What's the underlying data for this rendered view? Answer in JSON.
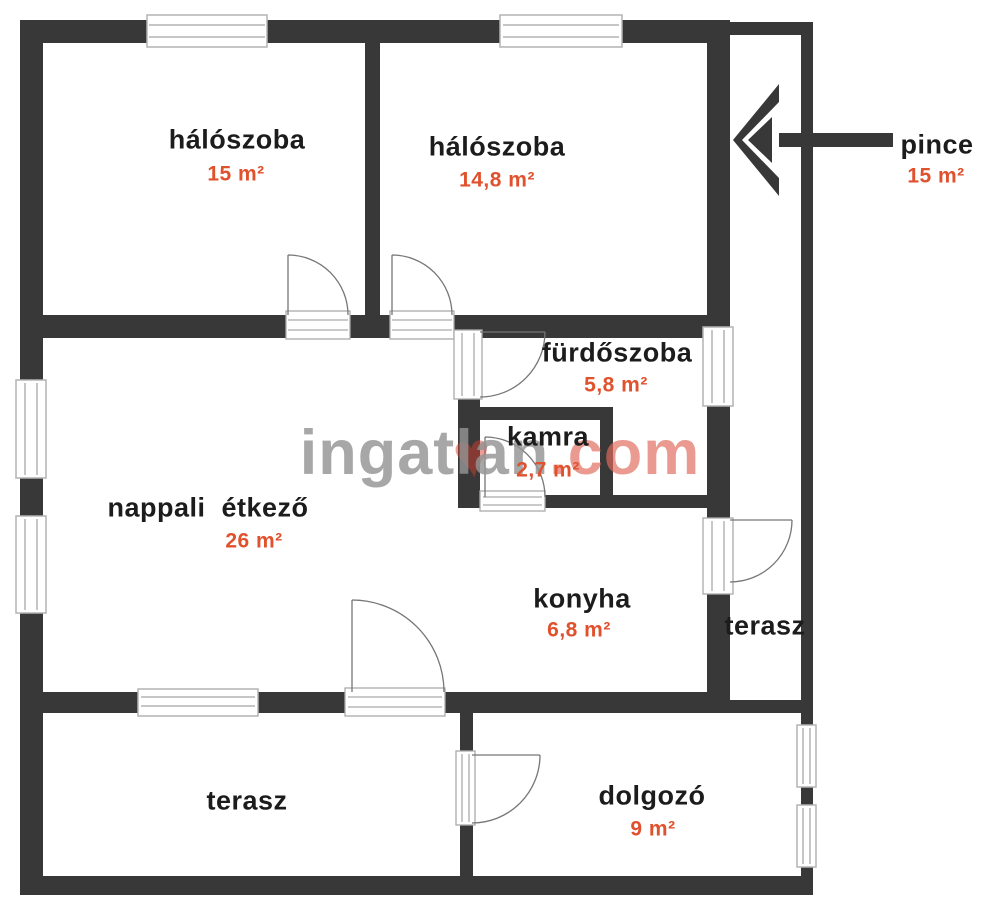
{
  "plan": {
    "title_hint": "floor plan",
    "colors": {
      "wall": "#383838",
      "room_label": "#1c1c1c",
      "area_accent": "#e0512d",
      "watermark_gray": "#949494",
      "watermark_red": "#e06a5c"
    },
    "watermark": {
      "gray_text": "ingatlan",
      "red_text": ".com",
      "heart_glyph": "♥"
    },
    "rooms": [
      {
        "id": "haloszoba-1",
        "name": "hálószoba",
        "area": "15 m²"
      },
      {
        "id": "haloszoba-2",
        "name": "hálószoba",
        "area": "14,8 m²"
      },
      {
        "id": "pince",
        "name": "pince",
        "area": "15 m²"
      },
      {
        "id": "furdoszoba",
        "name": "fürdőszoba",
        "area": "5,8 m²"
      },
      {
        "id": "kamra",
        "name": "kamra",
        "area": "2,7 m²"
      },
      {
        "id": "nappali-etkezo",
        "name": "nappali  étkező",
        "area": "26 m²"
      },
      {
        "id": "konyha",
        "name": "konyha",
        "area": "6,8 m²"
      },
      {
        "id": "terasz-jobb",
        "name": "terasz",
        "area": ""
      },
      {
        "id": "terasz-also",
        "name": "terasz",
        "area": ""
      },
      {
        "id": "dolgozo",
        "name": "dolgozó",
        "area": "9 m²"
      }
    ]
  }
}
